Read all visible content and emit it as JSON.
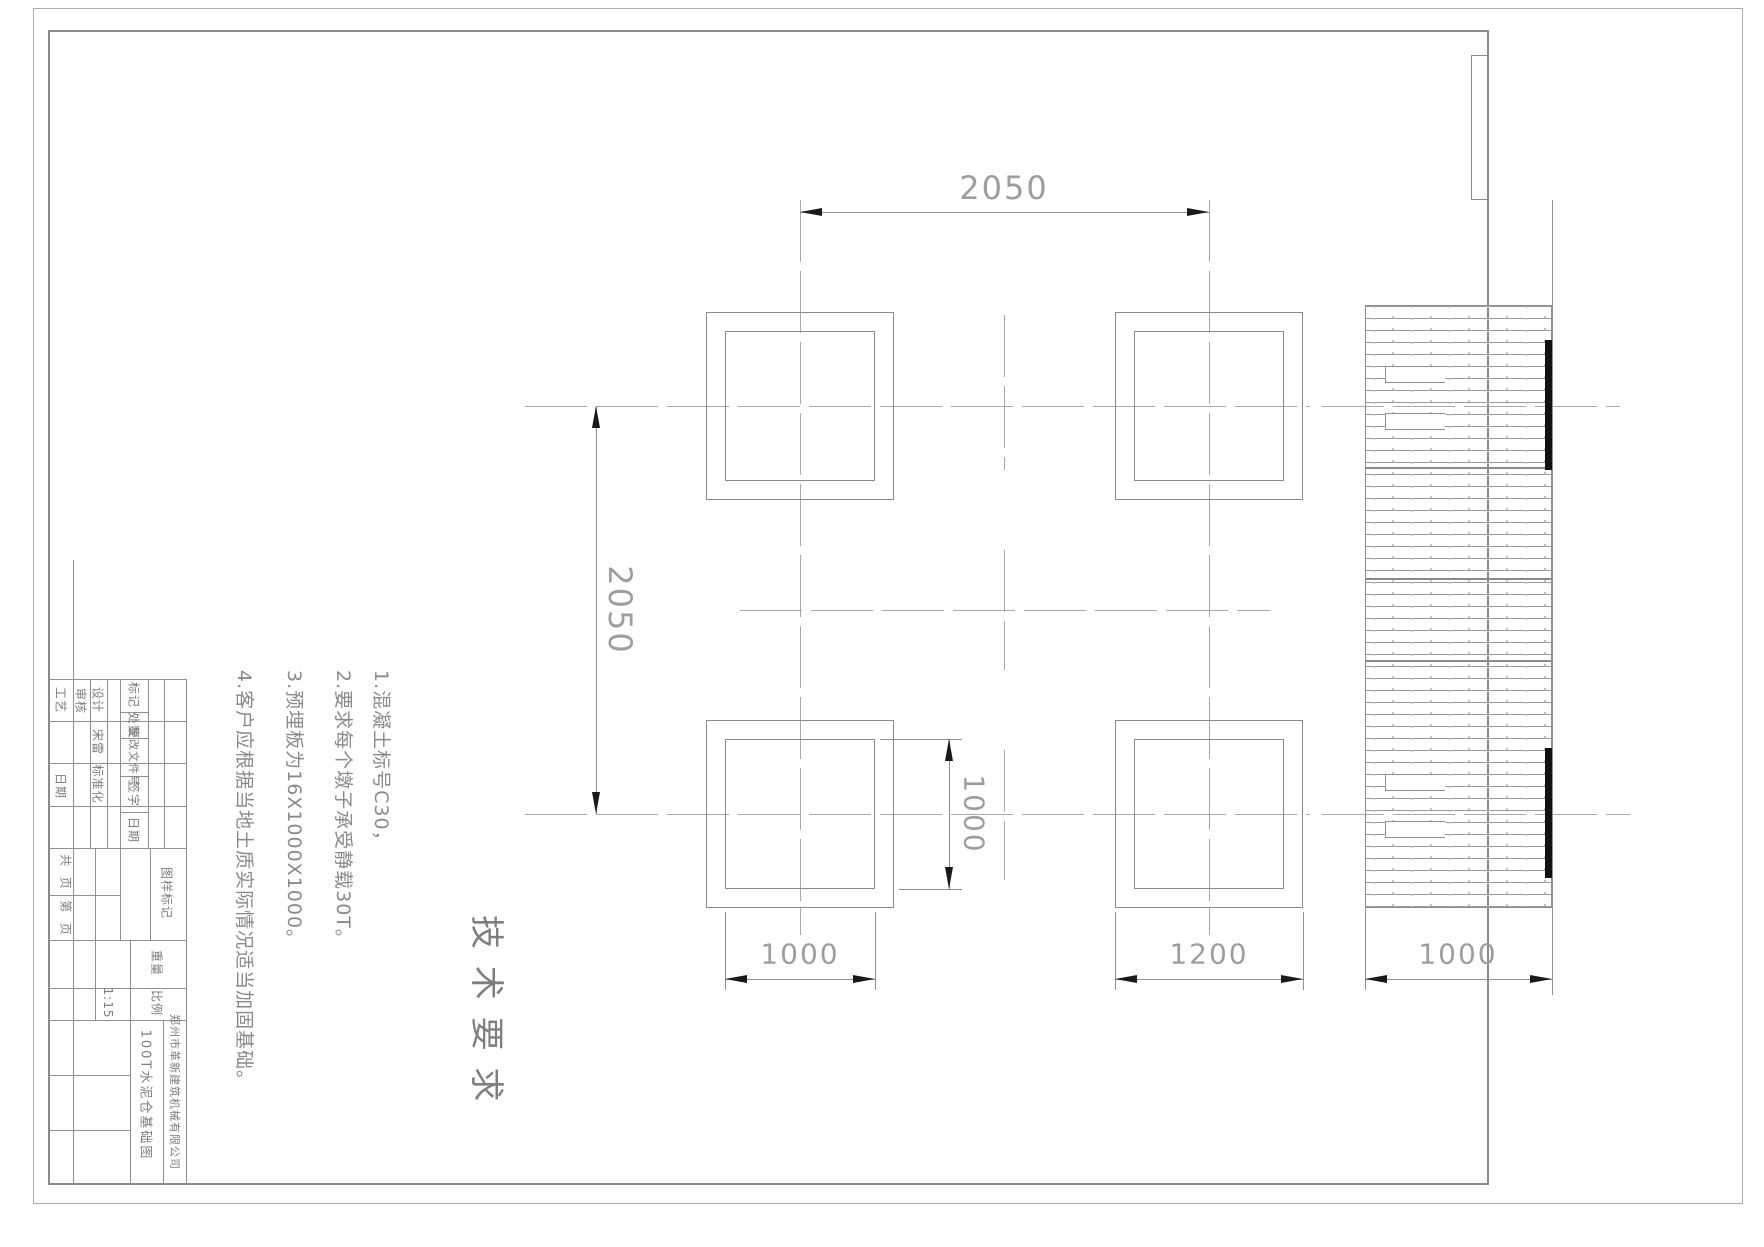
{
  "dimensions": {
    "top_span": "2050",
    "left_span": "2050",
    "plate_width_bottom": "1000",
    "pad_width_bottom": "1200",
    "section_width_bottom": "1000",
    "plate_height_side": "1000"
  },
  "tech_requirements": {
    "title": "技 术 要 求",
    "notes": [
      "1.混凝土标号C30，",
      "2.要求每个墩子承受静载30T。",
      "3.预埋板为16X1000X1000。",
      "4.客户应根据当地土质实际情况适当加固基础。"
    ]
  },
  "title_block": {
    "labels": {
      "process": "工艺",
      "process_date": "日期",
      "review": "审核",
      "design": "设计",
      "designer": "宋雷",
      "standardization": "标准化",
      "mark": "标记",
      "count": "处数",
      "change_doc": "更改文件号",
      "sign": "签字",
      "date": "日期",
      "drawing_mark": "图样标记",
      "weight": "重量",
      "scale_label": "比例",
      "total_pages": "共  页",
      "page_no": "第  页"
    },
    "scale_value": "1:15",
    "drawing_title": "100T水泥仓基础图",
    "company": "郑州市革新建筑机械有限公司"
  }
}
